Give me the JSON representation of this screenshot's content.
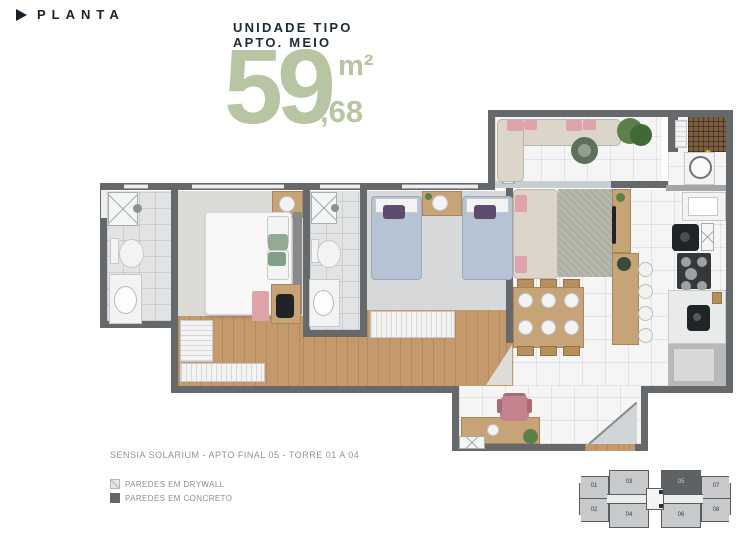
{
  "header": {
    "label": "PLANTA"
  },
  "unit_info": {
    "line1": "UNIDADE TIPO",
    "line2": "APTO. MEIO",
    "area_integer": "59",
    "area_unit": "m²",
    "area_decimal": ",68"
  },
  "caption": "SENSIA SOLARIUM - APTO FINAL 05 - TORRE 01 A 04",
  "legend": {
    "items": [
      {
        "label": "PAREDES EM DRYWALL",
        "type": "drywall"
      },
      {
        "label": "PAREDES EM CONCRETO",
        "type": "concrete"
      }
    ]
  },
  "keyplan": {
    "units": [
      {
        "label": "01"
      },
      {
        "label": "02"
      },
      {
        "label": "03"
      },
      {
        "label": "04"
      },
      {
        "label": "05"
      },
      {
        "label": "06"
      },
      {
        "label": "07"
      },
      {
        "label": "08"
      }
    ],
    "highlighted_unit": "05"
  },
  "colors": {
    "accent_green": "#b7c5a3",
    "title_navy": "#1c2a35",
    "wall_concrete": "#66696c",
    "wall_drywall": "#c8cfd3",
    "wood": "#c49a6c",
    "text_gray": "#8f9396"
  }
}
